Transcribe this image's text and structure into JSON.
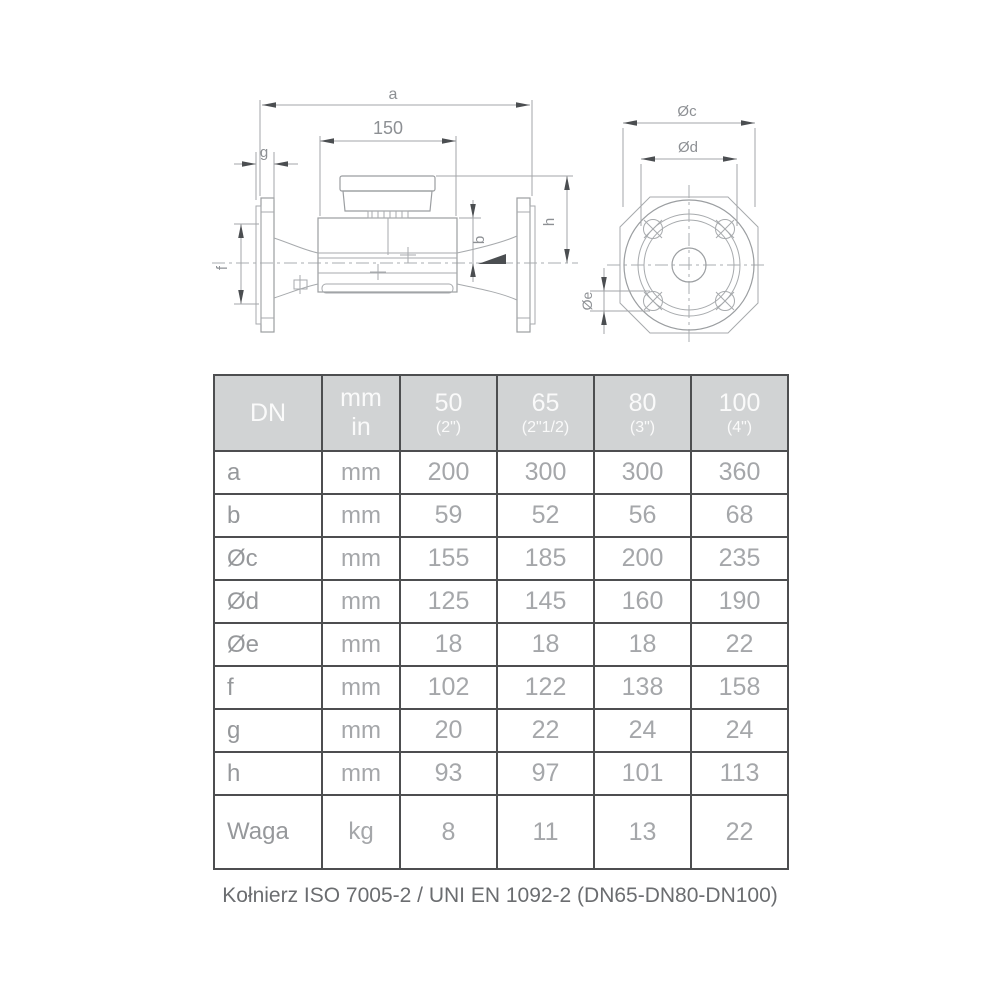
{
  "drawing": {
    "side_view": {
      "dim_a": "a",
      "dim_150": "150",
      "dim_g": "g",
      "dim_f": "f",
      "dim_b": "b",
      "dim_h": "h"
    },
    "front_view": {
      "dim_c": "Øc",
      "dim_d": "Ød",
      "dim_e": "Øe"
    }
  },
  "table": {
    "header": {
      "dn": "DN",
      "unit_line1": "mm",
      "unit_line2": "in",
      "columns": [
        {
          "size": "50",
          "inches": "(2\")"
        },
        {
          "size": "65",
          "inches": "(2\"1/2)"
        },
        {
          "size": "80",
          "inches": "(3\")"
        },
        {
          "size": "100",
          "inches": "(4\")"
        }
      ]
    },
    "rows": [
      {
        "label": "a",
        "unit": "mm",
        "values": [
          "200",
          "300",
          "300",
          "360"
        ]
      },
      {
        "label": "b",
        "unit": "mm",
        "values": [
          "59",
          "52",
          "56",
          "68"
        ]
      },
      {
        "label": "Øc",
        "unit": "mm",
        "values": [
          "155",
          "185",
          "200",
          "235"
        ]
      },
      {
        "label": "Ød",
        "unit": "mm",
        "values": [
          "125",
          "145",
          "160",
          "190"
        ]
      },
      {
        "label": "Øe",
        "unit": "mm",
        "values": [
          "18",
          "18",
          "18",
          "22"
        ]
      },
      {
        "label": "f",
        "unit": "mm",
        "values": [
          "102",
          "122",
          "138",
          "158"
        ]
      },
      {
        "label": "g",
        "unit": "mm",
        "values": [
          "20",
          "22",
          "24",
          "24"
        ]
      },
      {
        "label": "h",
        "unit": "mm",
        "values": [
          "93",
          "97",
          "101",
          "113"
        ]
      },
      {
        "label": "Waga",
        "unit": "kg",
        "values": [
          "8",
          "11",
          "13",
          "22"
        ]
      }
    ]
  },
  "footer": {
    "note": "Kołnierz ISO 7005-2 / UNI EN 1092-2 (DN65-DN80-DN100)"
  }
}
